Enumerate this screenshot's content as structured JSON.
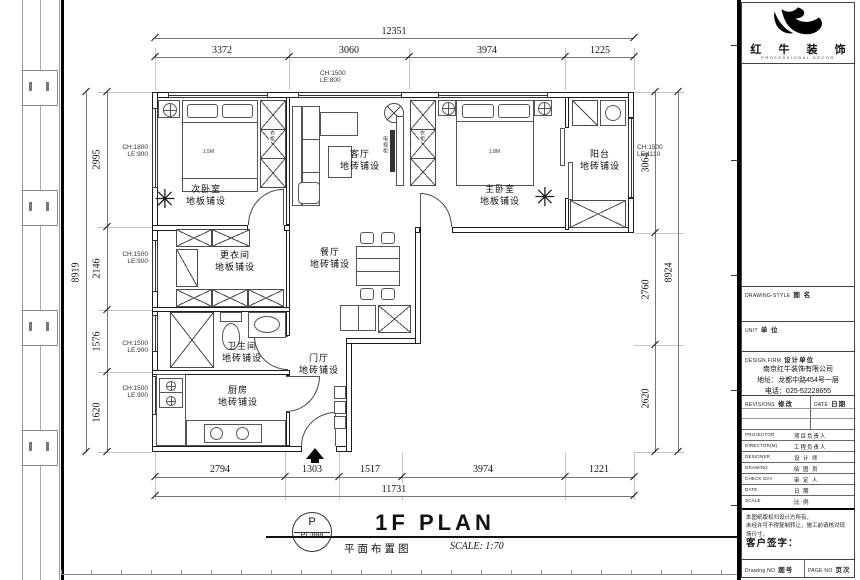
{
  "plan": {
    "rooms": [
      {
        "name": "次卧室",
        "finish": "地板铺设"
      },
      {
        "name": "客厅",
        "finish": "地砖铺设"
      },
      {
        "name": "主卧室",
        "finish": "地板铺设"
      },
      {
        "name": "阳台",
        "finish": "地砖铺设"
      },
      {
        "name": "更衣间",
        "finish": "地板铺设"
      },
      {
        "name": "餐厅",
        "finish": "地砖铺设"
      },
      {
        "name": "卫生间",
        "finish": "地砖铺设"
      },
      {
        "name": "厨房",
        "finish": "地砖铺设"
      },
      {
        "name": "门厅",
        "finish": "地砖铺设"
      }
    ],
    "furniture": {
      "wardrobe": "衣柜",
      "tv_cabinet": "电视柜",
      "bed2_size": "1.5M",
      "bed1_size": "1.8M"
    },
    "window_marks": [
      {
        "text": "CH:1500\nLE:800"
      },
      {
        "text": "CH:1800\nLE:900"
      },
      {
        "text": "CH:1500\nLE:900"
      },
      {
        "text": "CH:1500\nLE:900"
      },
      {
        "text": "CH:1500\nLE:900"
      },
      {
        "text": "CH:1500\nLE:1110"
      }
    ],
    "dimensions": {
      "top": {
        "total": "12351",
        "segments": [
          "3372",
          "3060",
          "3974",
          "1225"
        ]
      },
      "bottom": {
        "total": "11731",
        "segments": [
          "2794",
          "1303",
          "1517",
          "3974",
          "1221"
        ]
      },
      "left": {
        "total": "8919",
        "segments": [
          "2995",
          "2146",
          "1576",
          "1620"
        ]
      },
      "right": {
        "total": "8924",
        "segments": [
          "3064",
          "2760",
          "2620"
        ]
      }
    }
  },
  "logo": {
    "name_cn": "红 牛 装 饰",
    "name_en": "PROFESSIONAL DECOR"
  },
  "titleblock": {
    "sections": [
      {
        "en": "DRAWING-STYLE",
        "cn": "图 名"
      },
      {
        "en": "UNIT",
        "cn": "单 位"
      },
      {
        "en": "DESIGN FIRM",
        "cn": "设计单位"
      }
    ],
    "company": {
      "name": "南京红牛装饰有限公司",
      "address": "地址：龙都中路454号一层",
      "phone": "电话：025-52228655"
    },
    "revisions_header": {
      "left_en": "REVISIONS",
      "left_cn": "修改",
      "right_en": "DATE",
      "right_cn": "日期"
    },
    "rows": [
      {
        "en": "PROJECTOR",
        "cn": "项目负责人"
      },
      {
        "en": "DIRECTOR(M)",
        "cn": "工程负责人"
      },
      {
        "en": "DESIGNER",
        "cn": "设 计 师"
      },
      {
        "en": "DRAWING",
        "cn": "绘 图 员"
      },
      {
        "en": "CHECK DAY",
        "cn": "审 定 人"
      },
      {
        "en": "DATE",
        "cn": "日  期"
      },
      {
        "en": "SCALE",
        "cn": "比  例"
      }
    ],
    "note_line1": "本图纸版权归设计方所有，",
    "note_line2": "未经许可不得复制转让，施工前请核对现场尺寸。",
    "signature_label": "客户签字：",
    "bottom": {
      "left_en": "Drawing NO",
      "left_cn": "图号",
      "right_en": "PAGE NO",
      "right_cn": "页次"
    }
  },
  "footer": {
    "stamp_top": "P",
    "stamp_bottom": "PL-888",
    "title_cn": "平面布置图",
    "title_en": "1F PLAN",
    "scale": "SCALE: 1:70"
  }
}
